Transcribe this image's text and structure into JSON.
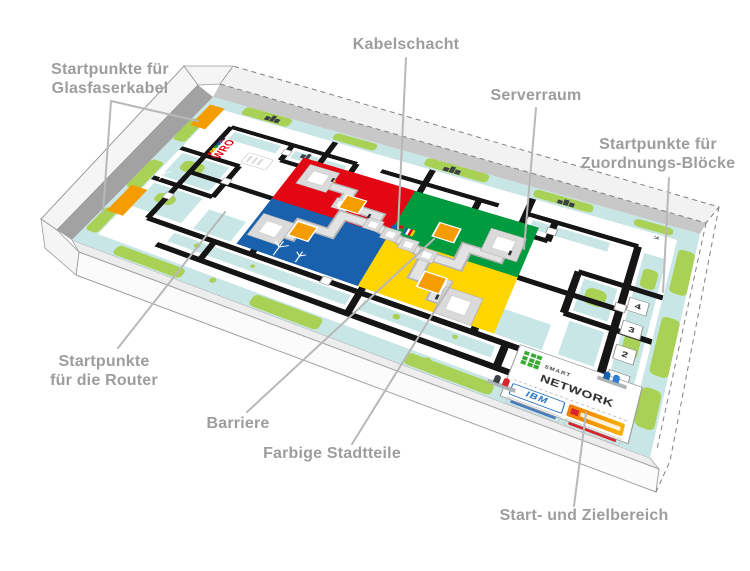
{
  "labels": {
    "glasfaserkabel": {
      "line1": "Startpunkte für",
      "line2": "Glasfaserkabel"
    },
    "kabelschacht": {
      "line1": "Kabelschacht"
    },
    "serverraum": {
      "line1": "Serverraum"
    },
    "zuordnung": {
      "line1": "Startpunkte für",
      "line2": "Zuordnungs-Blöcke"
    },
    "router": {
      "line1": "Startpunkte",
      "line2": "für die Router"
    },
    "barriere": {
      "line1": "Barriere"
    },
    "stadtteile": {
      "line1": "Farbige Stadtteile"
    },
    "zielbereich": {
      "line1": "Start- und Zielbereich"
    }
  },
  "mat": {
    "wro_logo_text": "WRO",
    "start_numbers": [
      "4",
      "3",
      "2",
      "1"
    ],
    "panel": {
      "brand_top": "SMART",
      "brand_main": "NETWORK",
      "sponsor_ibm": "IBM"
    }
  },
  "colors": {
    "red": "#e30613",
    "green": "#009b3e",
    "blue": "#1961ac",
    "yellow": "#ffd500",
    "orange": "#f59c00",
    "water": "#c9e6e6",
    "land": "#a9d155",
    "label-gray": "#9d9d9d",
    "leader-gray": "#b8b8b8",
    "road": "#151515",
    "duct": "#dcdcdc",
    "ibm-blue": "#1f70c1",
    "panel-green": "#3aaa35"
  }
}
